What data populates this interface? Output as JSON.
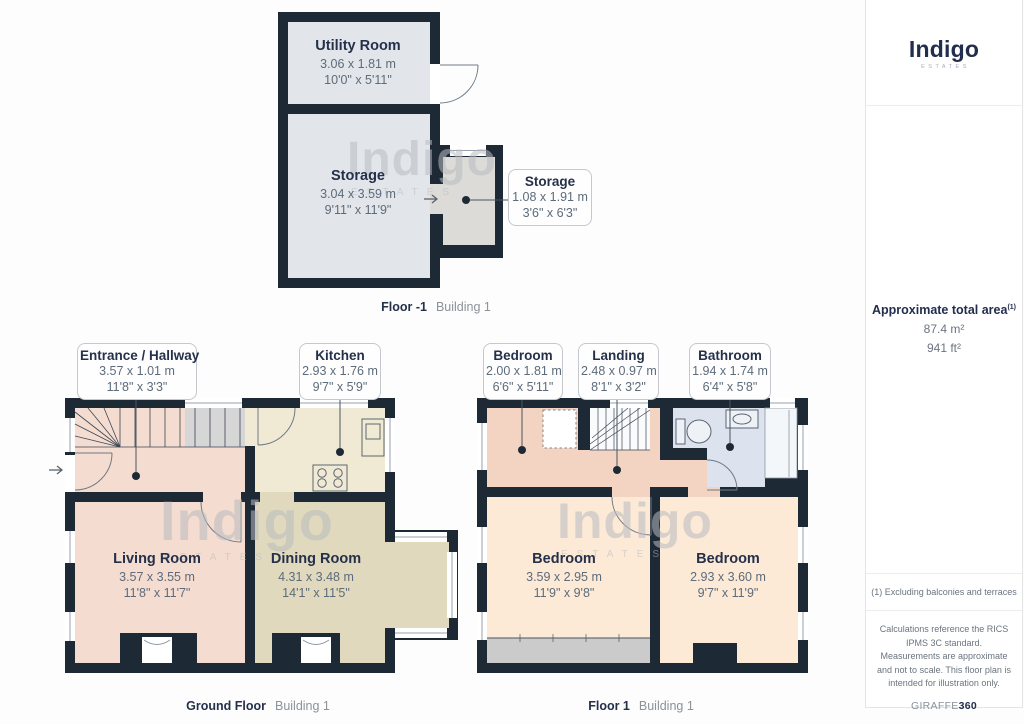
{
  "branding": {
    "logo": "Indigo",
    "logo_sub": "ESTATES"
  },
  "watermark": {
    "word": "Indigo",
    "sub": "ESTATES"
  },
  "sidebar": {
    "area_title": "Approximate total area",
    "area_superscript": "(1)",
    "area_m2": "87.4 m²",
    "area_ft2": "941 ft²",
    "footnote": "(1) Excluding balconies and terraces",
    "disclaimer": "Calculations reference the RICS IPMS 3C standard. Measurements are approximate and not to scale. This floor plan is intended for illustration only.",
    "brand_footer_light": "GIRAFFE",
    "brand_footer_bold": "360"
  },
  "floors": [
    {
      "caption_bold": "Floor -1",
      "caption_light": "Building 1",
      "rooms": [
        {
          "name": "Utility Room",
          "metric": "3.06 x 1.81 m",
          "imperial": "10'0\" x 5'11\""
        },
        {
          "name": "Storage",
          "metric": "3.04 x 3.59 m",
          "imperial": "9'11\" x 11'9\""
        }
      ],
      "callouts": [
        {
          "name": "Storage",
          "metric": "1.08 x 1.91 m",
          "imperial": "3'6\" x 6'3\""
        }
      ]
    },
    {
      "caption_bold": "Ground Floor",
      "caption_light": "Building 1",
      "rooms": [
        {
          "name": "Living Room",
          "metric": "3.57 x 3.55 m",
          "imperial": "11'8\" x 11'7\""
        },
        {
          "name": "Dining Room",
          "metric": "4.31 x 3.48 m",
          "imperial": "14'1\" x 11'5\""
        }
      ],
      "callouts": [
        {
          "name": "Entrance / Hallway",
          "metric": "3.57 x 1.01 m",
          "imperial": "11'8\" x 3'3\""
        },
        {
          "name": "Kitchen",
          "metric": "2.93 x 1.76 m",
          "imperial": "9'7\" x 5'9\""
        }
      ]
    },
    {
      "caption_bold": "Floor 1",
      "caption_light": "Building 1",
      "rooms": [
        {
          "name": "Bedroom",
          "metric": "3.59 x 2.95 m",
          "imperial": "11'9\" x 9'8\""
        },
        {
          "name": "Bedroom",
          "metric": "2.93 x 3.60 m",
          "imperial": "9'7\" x 11'9\""
        }
      ],
      "callouts": [
        {
          "name": "Bedroom",
          "metric": "2.00 x 1.81 m",
          "imperial": "6'6\" x 5'11\""
        },
        {
          "name": "Landing",
          "metric": "2.48 x 0.97 m",
          "imperial": "8'1\" x 3'2\""
        },
        {
          "name": "Bathroom",
          "metric": "1.94 x 1.74 m",
          "imperial": "6'4\" x 5'8\""
        }
      ]
    }
  ]
}
